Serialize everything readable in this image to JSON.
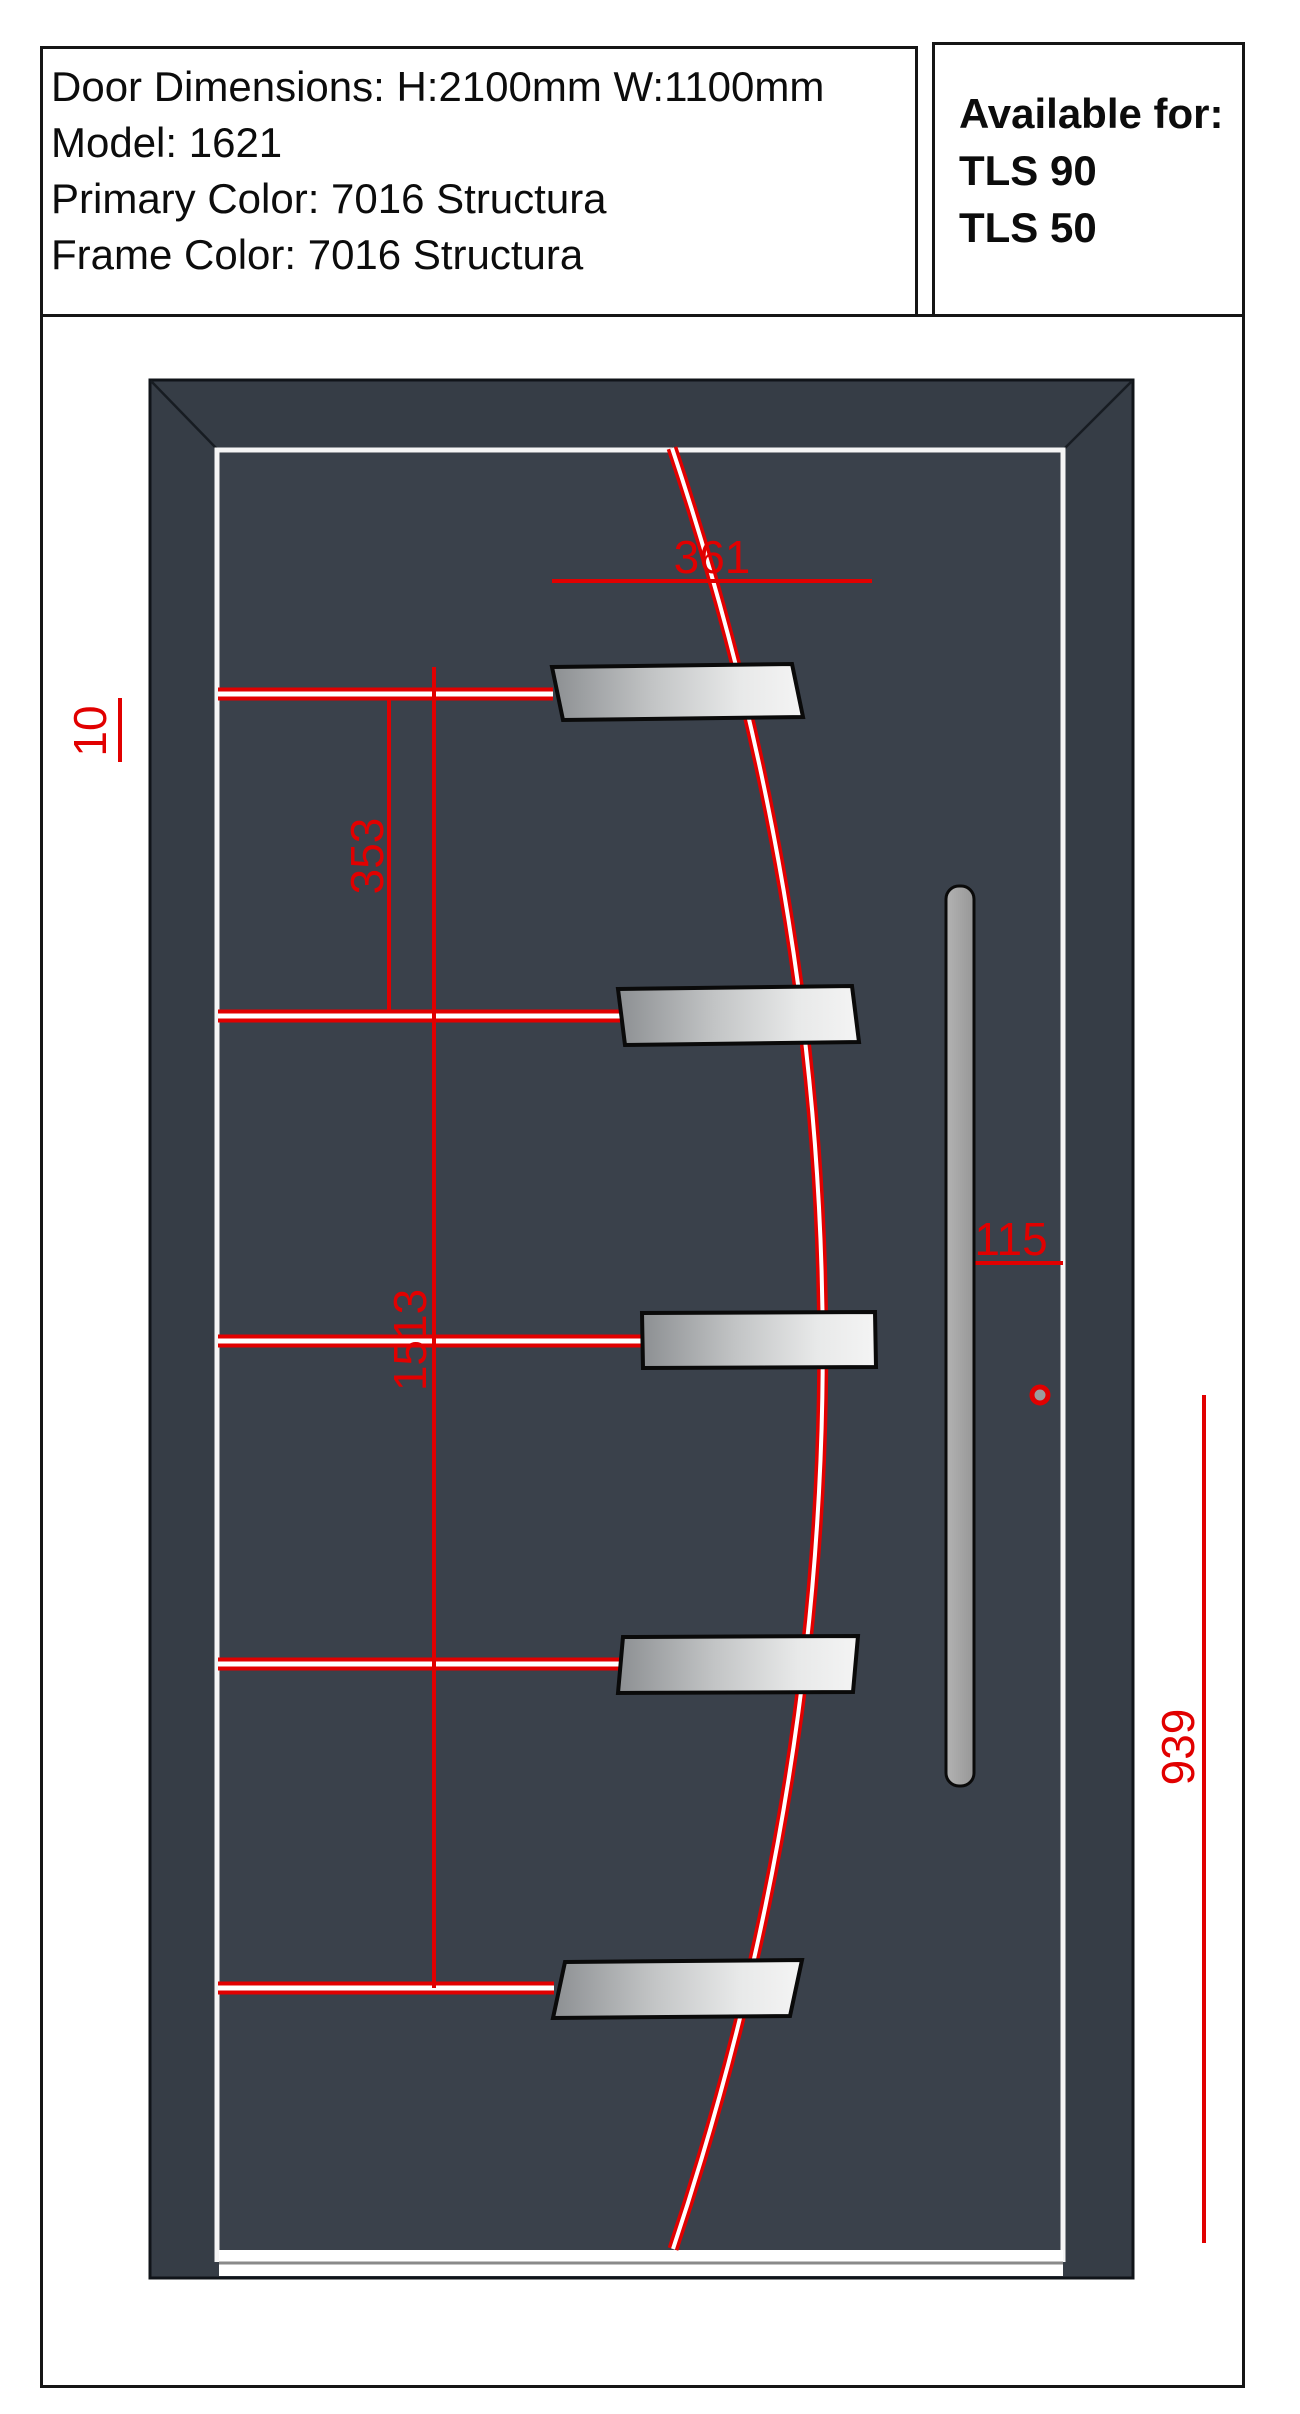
{
  "specs": {
    "dimensions": "Door Dimensions: H:2100mm W:1100mm",
    "model": "Model: 1621",
    "primary_color": "Primary Color: 7016 Structura",
    "frame_color": "Frame Color: 7016 Structura"
  },
  "availability": {
    "title": "Available for:",
    "options": [
      "TLS 90",
      "TLS 50"
    ]
  },
  "dimension_labels": {
    "top_width": "361",
    "edge_offset": "10",
    "bar_spacing": "353",
    "mid_height": "1513",
    "handle_offset": "115",
    "handle_zone_height": "939"
  },
  "colors": {
    "annotation_red": "#e10000",
    "door_frame": "#363d46",
    "door_panel": "#3a414b",
    "applique_light": "#f4f4f4",
    "applique_dark": "#8c8f92",
    "handle_gray": "#a6a6a6"
  }
}
